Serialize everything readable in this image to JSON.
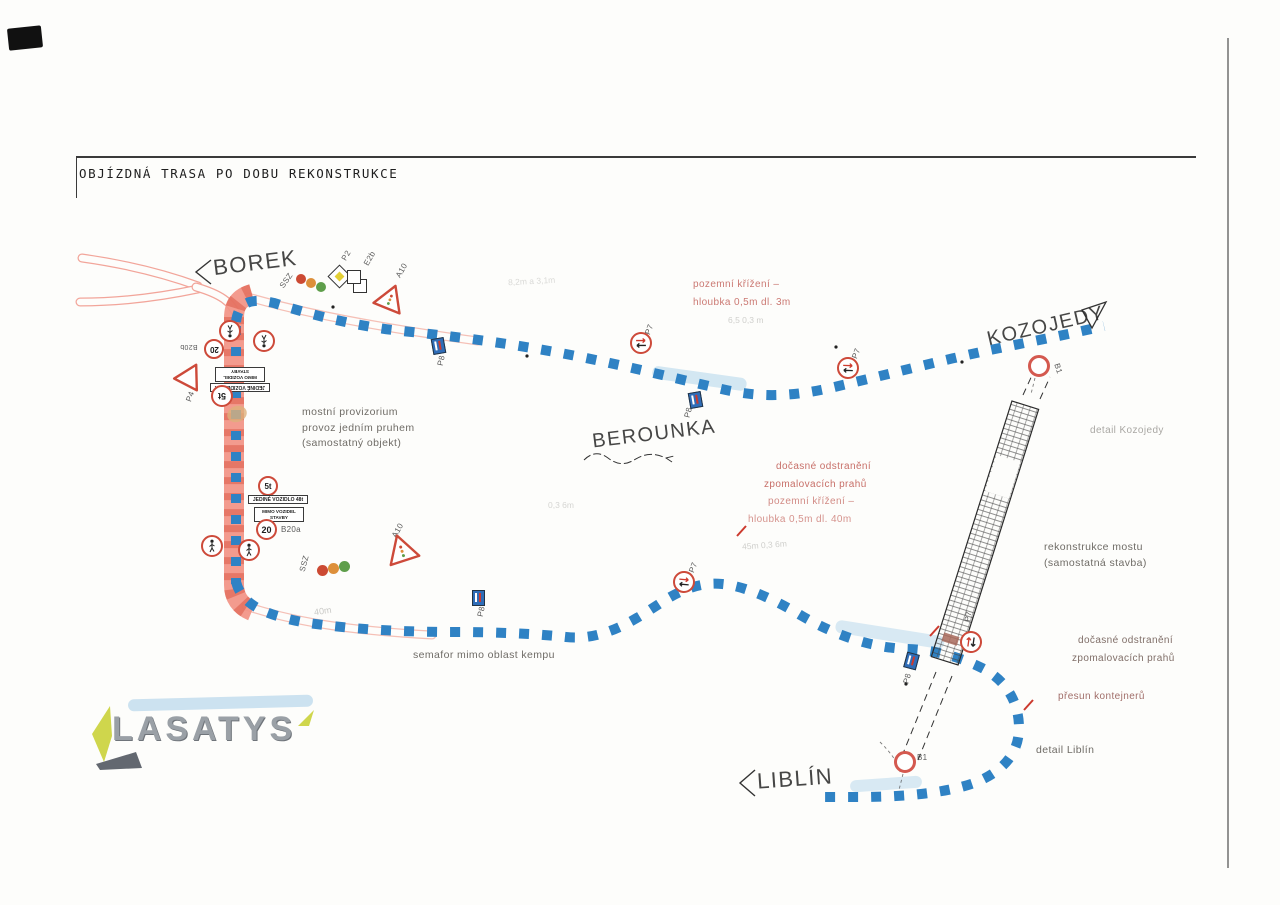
{
  "title": "OBJÍZDNÁ TRASA PO DOBU REKONSTRUKCE",
  "places": {
    "borek": "BOREK",
    "kozojedy": "KOZOJEDY",
    "berounka": "BEROUNKA",
    "liblin": "LIBLÍN"
  },
  "notes": {
    "bridge_provisional_1": "mostní provizorium",
    "bridge_provisional_2": "provoz jedním pruhem",
    "bridge_provisional_3": "(samostatný objekt)",
    "semafor": "semafor mimo oblast kempu",
    "rekonstrukce_1": "rekonstrukce mostu",
    "rekonstrukce_2": "(samostatná stavba)",
    "detail_kozojedy": "detail Kozojedy",
    "detail_liblin": "detail Liblín",
    "red_top_1": "pozemní křížení –",
    "red_top_2": "hloubka 0,5m dl. 3m",
    "red_mid_1": "dočasné odstranění",
    "red_mid_2": "zpomalovacích prahů",
    "red_mid_3": "pozemní křížení –",
    "red_mid_4": "hloubka 0,5m dl. 40m",
    "red_right_1": "dočasné odstranění",
    "red_right_2": "zpomalovacích prahů",
    "red_right_3": "přesun kontejnerů",
    "meas_top": "8,2m a 3,1m",
    "meas_top2": "6,5  0,3 m",
    "meas_mid": "0,3   6m",
    "meas_mid2": "45m  0,3  6m",
    "meas_40m": "40m"
  },
  "signs": {
    "ssz": "SSZ",
    "p2": "P2",
    "e2b": "E2b",
    "a10": "A10",
    "p4": "P4",
    "p7": "P7",
    "p8": "P8",
    "b1": "B1",
    "b20a": "B20a",
    "b20b": "B20b",
    "speed20": "20",
    "weight5t": "5t",
    "plate_single_vehicle": "JEDINÉ VOZIDLO 48t",
    "plate_mimo_1": "MIMO VOZIDEL",
    "plate_mimo_2": "STAVBY"
  },
  "logo": {
    "text": "LASATYS"
  },
  "colors": {
    "route_blue": "#2f82c4",
    "construction_red": "#f29384",
    "construction_dash": "#da5340",
    "sign_red": "#cd4a3a",
    "note_red": "#b8463e",
    "highlight_blue": "#8fc3e4",
    "logo_gray": "#9aa0a6",
    "logo_accent": "#cfd64c",
    "traffic_red": "#cc4a33",
    "traffic_orange": "#dd8f3a",
    "traffic_green": "#5e9e4a"
  }
}
